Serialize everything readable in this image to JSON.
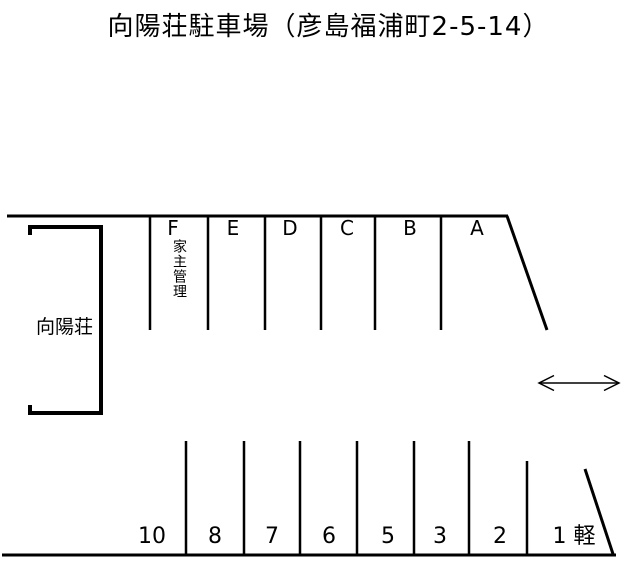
{
  "title": "向陽荘駐車場（彦島福浦町2-5-14）",
  "colors": {
    "line": "#000000",
    "background": "#ffffff"
  },
  "building": {
    "label": "向陽荘"
  },
  "upper_row": {
    "spaces": [
      {
        "label": "F",
        "note": "家主管理"
      },
      {
        "label": "E"
      },
      {
        "label": "D"
      },
      {
        "label": "C"
      },
      {
        "label": "B"
      },
      {
        "label": "A"
      }
    ]
  },
  "lower_row": {
    "spaces": [
      {
        "label": "10"
      },
      {
        "label": "8"
      },
      {
        "label": "7"
      },
      {
        "label": "6"
      },
      {
        "label": "5"
      },
      {
        "label": "3"
      },
      {
        "label": "2"
      },
      {
        "label": "1 軽"
      }
    ]
  },
  "icons": {
    "entrance_arrow": "double-headed-horizontal-arrow"
  }
}
